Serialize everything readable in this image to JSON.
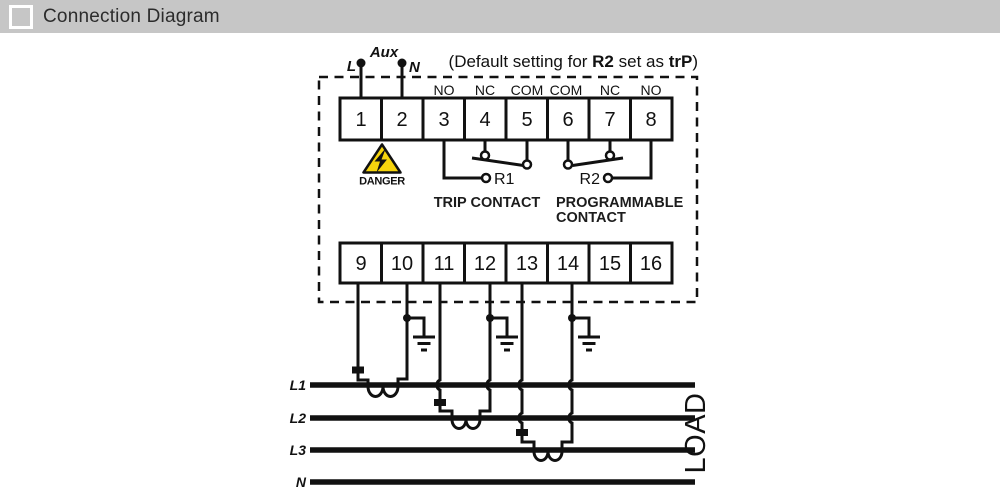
{
  "header": {
    "title": "Connection Diagram"
  },
  "note": {
    "prefix": "(Default setting for ",
    "bold1": "R2",
    "middle": " set as ",
    "bold2": "trP",
    "suffix": ")"
  },
  "aux": {
    "label": "Aux",
    "left": "L",
    "right": "N"
  },
  "relay_labels": [
    "NO",
    "NC",
    "COM",
    "COM",
    "NC",
    "NO"
  ],
  "terminals": {
    "top": [
      "1",
      "2",
      "3",
      "4",
      "5",
      "6",
      "7",
      "8"
    ],
    "bottom": [
      "9",
      "10",
      "11",
      "12",
      "13",
      "14",
      "15",
      "16"
    ]
  },
  "danger": {
    "label": "DANGER"
  },
  "contacts": {
    "r1": "R1",
    "r1_desc": "TRIP CONTACT",
    "r2": "R2",
    "r2_desc_line1": "PROGRAMMABLE",
    "r2_desc_line2": "CONTACT"
  },
  "phases": {
    "l1": "L1",
    "l2": "L2",
    "l3": "L3",
    "n": "N",
    "load": "LOAD"
  },
  "colors": {
    "header_bg": "#c6c6c6",
    "line": "#111111",
    "danger_yellow": "#f6d40d"
  }
}
